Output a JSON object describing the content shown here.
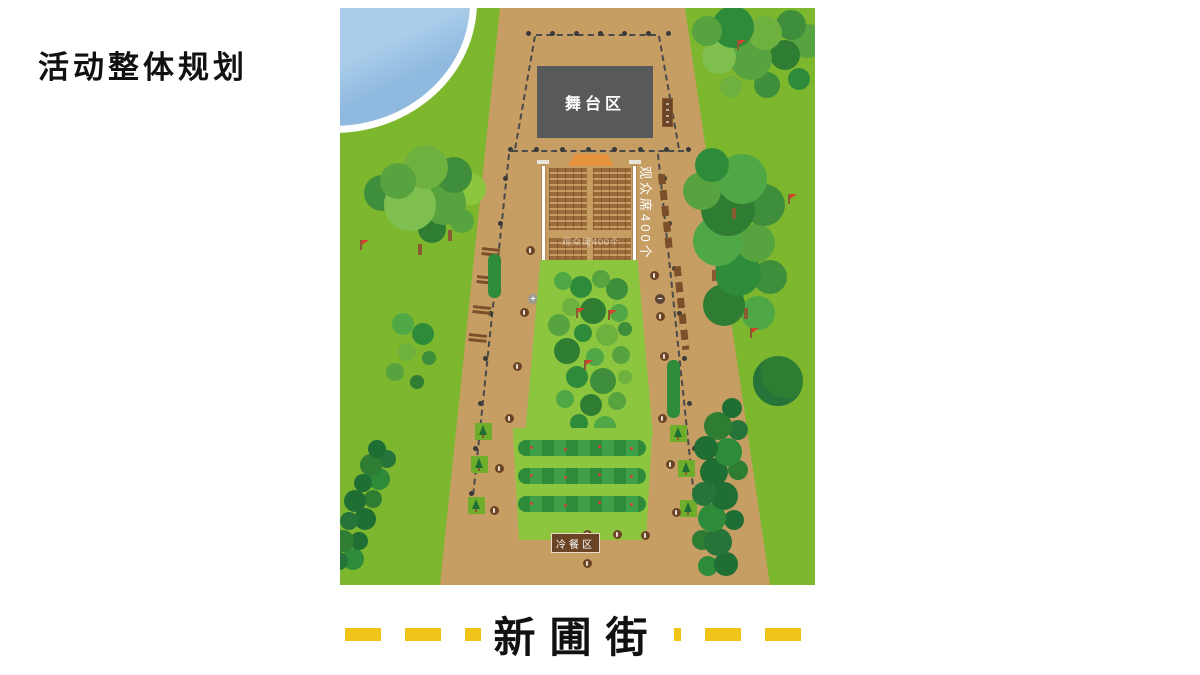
{
  "slide": {
    "title": "活动整体规划"
  },
  "map": {
    "stage_label": "舞台区",
    "audience_side_label": "观众席400个",
    "audience_watermark": "观众席400个",
    "buffet_sign": "冷餐区",
    "street_name": "新圃街"
  },
  "icons": {
    "plus_marker": "+",
    "minus_marker": "−"
  },
  "palette": {
    "grass": "#7CB72E",
    "flower_bed": "#8CC63F",
    "path_tan": "#C69D63",
    "stage_gray": "#58595B",
    "water_blue": "#8FB9DF",
    "street_dash_yellow": "#F0C419",
    "flag_red": "#D6402C",
    "marker_brown": "#6B4426",
    "seat_brown": "#9A6A3A"
  }
}
